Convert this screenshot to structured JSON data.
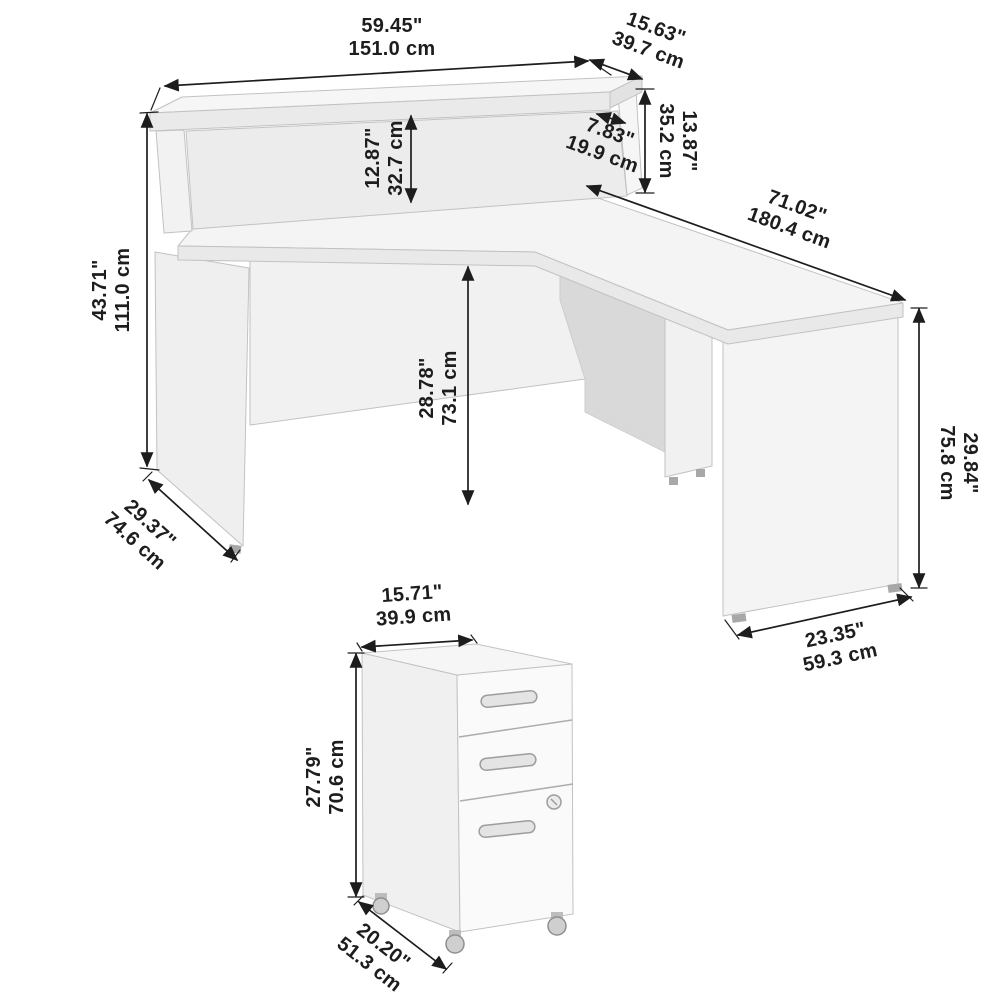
{
  "page": {
    "background": "#ffffff",
    "subject": "L-shaped reception desk with hutch and mobile file cabinet dimension diagram"
  },
  "colors": {
    "dimension_ink": "#1d1d1d",
    "surface_top": "#f5f5f5",
    "surface_front": "#fafafa",
    "surface_side": "#eeeeee",
    "surface_shadow": "#d8d8d8",
    "edge": "#bfbfbf",
    "hardware": "#c9c9c9"
  },
  "diagram": {
    "desk": {
      "dimensions": [
        {
          "id": "hutch-width",
          "in": "59.45\"",
          "cm": "151.0 cm"
        },
        {
          "id": "hutch-depth",
          "in": "15.63\"",
          "cm": "39.7 cm"
        },
        {
          "id": "hutch-height",
          "in": "13.87\"",
          "cm": "35.2 cm"
        },
        {
          "id": "hutch-interior-depth",
          "in": "7.83\"",
          "cm": "19.9 cm"
        },
        {
          "id": "hutch-opening-height",
          "in": "12.87\"",
          "cm": "32.7 cm"
        },
        {
          "id": "total-height",
          "in": "43.71\"",
          "cm": "111.0 cm"
        },
        {
          "id": "desk-depth",
          "in": "29.37\"",
          "cm": "74.6 cm"
        },
        {
          "id": "desk-height",
          "in": "28.78\"",
          "cm": "73.1 cm"
        },
        {
          "id": "return-length",
          "in": "71.02\"",
          "cm": "180.4 cm"
        },
        {
          "id": "return-height",
          "in": "29.84\"",
          "cm": "75.8 cm"
        },
        {
          "id": "return-depth",
          "in": "23.35\"",
          "cm": "59.3 cm"
        }
      ]
    },
    "cabinet": {
      "dimensions": [
        {
          "id": "cabinet-width",
          "in": "15.71\"",
          "cm": "39.9 cm"
        },
        {
          "id": "cabinet-height",
          "in": "27.79\"",
          "cm": "70.6 cm"
        },
        {
          "id": "cabinet-depth",
          "in": "20.20\"",
          "cm": "51.3 cm"
        }
      ]
    }
  }
}
